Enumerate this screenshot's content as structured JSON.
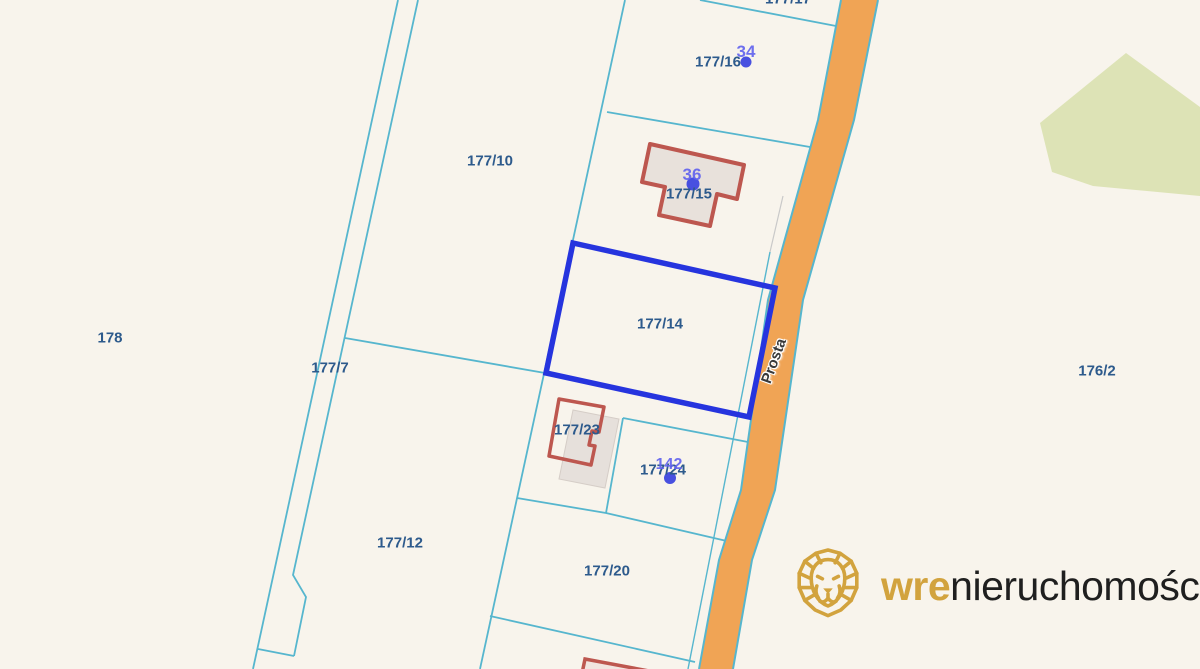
{
  "map": {
    "street": {
      "name": "Prosta"
    },
    "highlight": {
      "parcel": "177/14",
      "color": "#2634de"
    },
    "parcels": [
      {
        "label": "177/17"
      },
      {
        "label": "177/16"
      },
      {
        "label": "177/10"
      },
      {
        "label": "177/15"
      },
      {
        "label": "177/14"
      },
      {
        "label": "178"
      },
      {
        "label": "177/7"
      },
      {
        "label": "176/2"
      },
      {
        "label": "177/23"
      },
      {
        "label": "177/24"
      },
      {
        "label": "177/12"
      },
      {
        "label": "177/20"
      }
    ],
    "address_markers": [
      {
        "number": "34"
      },
      {
        "number": "36"
      },
      {
        "number": "142"
      }
    ],
    "colors": {
      "background": "#f8f4ec",
      "parcel_line": "#56b6ce",
      "road_fill": "#f0a455",
      "forest": "#dde3b6",
      "building_outline": "#bd574f",
      "building_fill": "#e8e1db",
      "parcel_label": "#2d5a8c",
      "marker_blue": "#6263ee",
      "highlight_blue": "#2634de"
    }
  },
  "watermark": {
    "brand_prefix": "wre",
    "brand_suffix": "nieruchomości",
    "gold": "#d2a33e",
    "icon": "lion-icon"
  }
}
